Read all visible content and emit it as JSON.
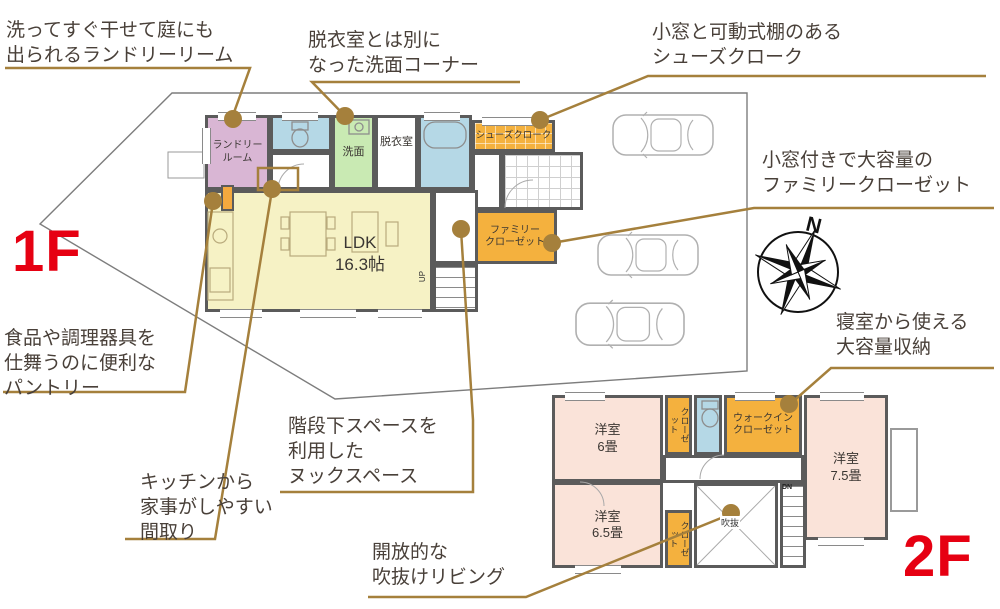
{
  "floor_labels": {
    "f1": "1F",
    "f2": "2F"
  },
  "colors": {
    "leader": "#a5803c",
    "boundary": "#7d7d7d",
    "wall": "#5b5b5b",
    "red_label": "#e60012",
    "room_laundry": "#d9b6d4",
    "room_toilet": "#b5d8e6",
    "room_wash": "#c9eab3",
    "room_bath": "#b5d8e6",
    "room_closet_orange": "#f4b13e",
    "room_ldk": "#f6f2c5",
    "room_bedroom": "#fae3d9"
  },
  "annotations": {
    "laundry": {
      "text": "洗ってすぐ干せて庭にも\n出られるランドリーリーム"
    },
    "wash_corner": {
      "text": "脱衣室とは別に\nなった洗面コーナー"
    },
    "shoe_cloak": {
      "text": "小窓と可動式棚のある\nシューズクローク"
    },
    "family_closet": {
      "text": "小窓付きで大容量の\nファミリークローゼット"
    },
    "pantry": {
      "text": "食品や調理器具を\n仕舞うのに便利な\nパントリー"
    },
    "kitchen": {
      "text": "キッチンから\n家事がしやすい\n間取り"
    },
    "nook": {
      "text": "階段下スペースを\n利用した\nヌックスペース"
    },
    "void_living": {
      "text": "開放的な\n吹抜けリビング"
    },
    "bedroom_storage": {
      "text": "寝室から使える\n大容量収納"
    }
  },
  "rooms_1f": {
    "laundry": "ランドリー\nルーム",
    "wash": "洗面",
    "dressing": "脱衣室",
    "shoe_cloak": "シューズクローク",
    "family_closet": "ファミリー\nクローゼット",
    "ldk": "LDK\n16.3帖",
    "up": "UP"
  },
  "rooms_2f": {
    "bedroom6": "洋室\n6畳",
    "bedroom65": "洋室\n6.5畳",
    "bedroom75": "洋室\n7.5畳",
    "walk_in_closet": "ウォークイン\nクローゼット",
    "closet_a": "クローゼット",
    "closet_b": "クローゼット",
    "void": "吹抜",
    "dn": "DN"
  },
  "compass": {
    "north": "N"
  }
}
